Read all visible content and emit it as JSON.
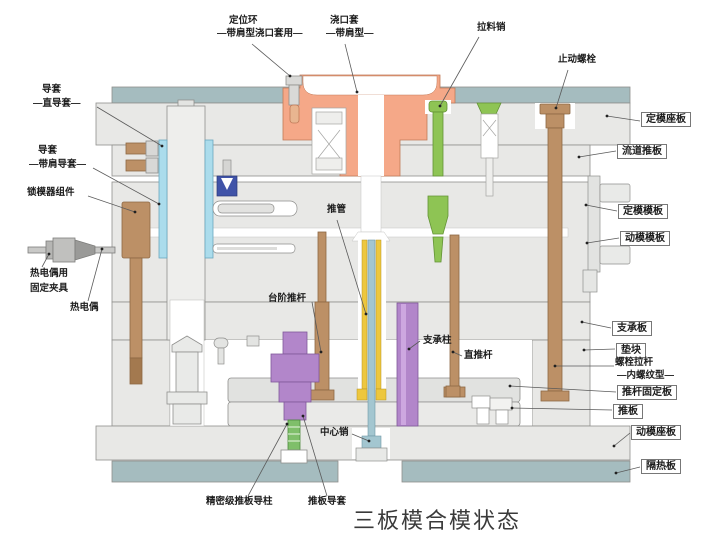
{
  "diagram": {
    "caption": "三板模合模状态",
    "colors": {
      "plate_gray": "#e8e8e6",
      "insulation_teal": "#a5bcbf",
      "sprue_orange": "#f5a888",
      "pull_pin_green": "#8ec454",
      "bolt_brown": "#bc9066",
      "pillar_purple": "#b286ca",
      "guide_bushing_blue": "#abdcec",
      "ejector_sleeve_yellow": "#edc73e",
      "center_pin_blue": "#a3c6d0",
      "insert_dark_blue": "#4053a8"
    },
    "labels": {
      "locating_ring": {
        "line1": "定位环",
        "line2": "—带肩型浇口套用—"
      },
      "sprue_bushing": {
        "line1": "浇口套",
        "line2": "—带肩型—"
      },
      "pull_pin": "拉料销",
      "stop_bolt": "止动螺栓",
      "guide_bushing_straight": {
        "line1": "导套",
        "line2": "—直导套—"
      },
      "guide_bushing_shoulder": {
        "line1": "导套",
        "line2": "—带肩导套—"
      },
      "mold_lock_assembly": "锁模器组件",
      "thermocouple_clamp": {
        "line1": "热电偶用",
        "line2": "固定夹具"
      },
      "thermocouple": "热电偶",
      "ejector_sleeve": "推管",
      "stepped_ejector_pin": "台阶推杆",
      "support_pillar": "支承柱",
      "straight_ejector_pin": "直推杆",
      "center_pin": "中心销",
      "precision_guide_pillar": "精密级推板导柱",
      "ejector_plate_bushing": "推板导套",
      "fixed_clamp_plate": "定模座板",
      "runner_stripper_plate": "流道推板",
      "fixed_mold_plate": "定模模板",
      "moving_mold_plate": "动模模板",
      "support_plate": "支承板",
      "spacer_block": "垫块",
      "puller_bolt": {
        "line1": "螺栓拉杆",
        "line2": "—内螺纹型—"
      },
      "ejector_retainer_plate": "推杆固定板",
      "ejector_plate": "推板",
      "moving_clamp_plate": "动模座板",
      "insulation_plate": "隔热板"
    }
  }
}
